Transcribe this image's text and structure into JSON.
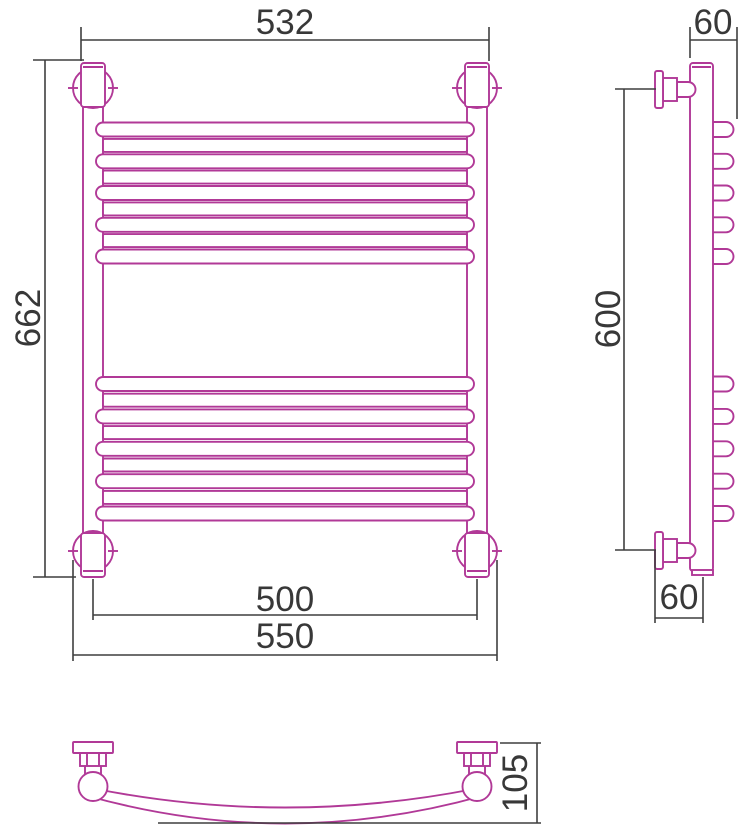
{
  "title": "heated-towel-rail-technical-drawing",
  "colors": {
    "outline": "#b13997",
    "dimension_line": "#3f3f3f",
    "dimension_text": "#383838",
    "background": "#ffffff"
  },
  "views": {
    "front": {
      "dimensions": {
        "top_width": "532",
        "height": "662",
        "rail_centers_width": "500",
        "overall_width": "550"
      }
    },
    "side": {
      "dimensions": {
        "top_depth": "60",
        "mounting_height": "600",
        "bottom_depth": "60"
      }
    },
    "bottom": {
      "dimensions": {
        "depth": "105"
      }
    }
  },
  "geometry": {
    "front_capsule_rung_centers": [
      129.5,
      161.3,
      193,
      224.8,
      256.5,
      384,
      416.4,
      448.8,
      481.2,
      513.5
    ],
    "front_plain_rung_centers": [
      145.4,
      177.1,
      208.9,
      240.6,
      400.2,
      432.6,
      465,
      497.4
    ],
    "side_bump_centers": [
      129.5,
      161.3,
      193,
      224.8,
      256.5,
      384,
      416.4,
      448.8,
      481.2,
      513.5
    ]
  }
}
